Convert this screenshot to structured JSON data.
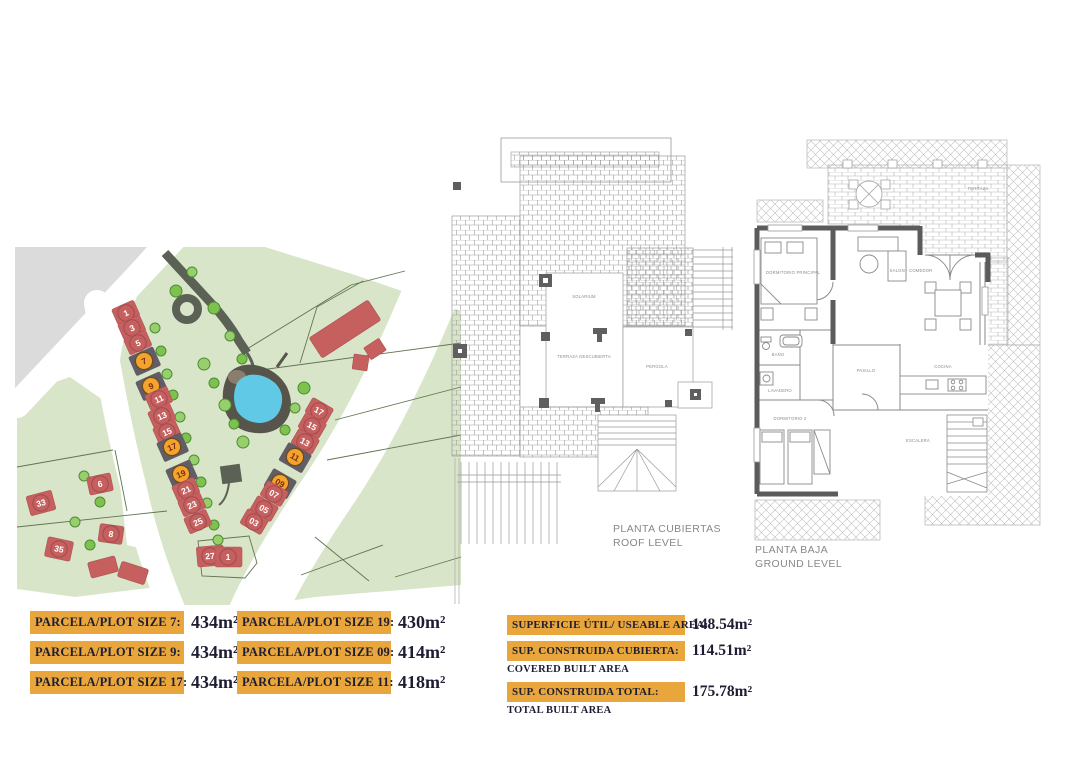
{
  "colors": {
    "table_bar": "#E8A63C",
    "table_text": "#1D1D33",
    "map_green": "#D8E5C9",
    "map_building": "#C6605F",
    "map_highlight": "#F3A42C",
    "map_pond": "#5FC9E6",
    "map_grey": "#DBDBDB",
    "plan_wall": "#5B5B5B"
  },
  "site_map": {
    "plots": [
      {
        "n": "1",
        "hl": false
      },
      {
        "n": "3",
        "hl": false
      },
      {
        "n": "5",
        "hl": false
      },
      {
        "n": "7",
        "hl": true
      },
      {
        "n": "9",
        "hl": true
      },
      {
        "n": "11",
        "hl": false
      },
      {
        "n": "13",
        "hl": false
      },
      {
        "n": "15",
        "hl": false
      },
      {
        "n": "17",
        "hl": true
      },
      {
        "n": "19",
        "hl": true
      },
      {
        "n": "21",
        "hl": false
      },
      {
        "n": "23",
        "hl": false
      },
      {
        "n": "25",
        "hl": false
      },
      {
        "n": "27",
        "hl": false
      },
      {
        "n": "1",
        "hl": false
      },
      {
        "n": "17",
        "hl": false
      },
      {
        "n": "15",
        "hl": false
      },
      {
        "n": "13",
        "hl": false
      },
      {
        "n": "11",
        "hl": true
      },
      {
        "n": "09",
        "hl": true
      },
      {
        "n": "07",
        "hl": false
      },
      {
        "n": "05",
        "hl": false
      },
      {
        "n": "03",
        "hl": false
      },
      {
        "n": "33",
        "hl": false
      },
      {
        "n": "35",
        "hl": false
      },
      {
        "n": "6",
        "hl": false
      },
      {
        "n": "8",
        "hl": false
      }
    ]
  },
  "plans": {
    "roof": {
      "title": "PLANTA CUBIERTAS",
      "subtitle": "ROOF LEVEL",
      "rooms": [
        {
          "name": "SOLARIUM"
        },
        {
          "name": "TERRAZA DESCUBIERTA"
        },
        {
          "name": "PERGOLA"
        }
      ]
    },
    "ground": {
      "title": "PLANTA BAJA",
      "subtitle": "GROUND LEVEL",
      "rooms": [
        {
          "name": "DORMITORIO PRINCIPAL"
        },
        {
          "name": "SALON - COMEDOR"
        },
        {
          "name": "COCINA"
        },
        {
          "name": "BAÑO"
        },
        {
          "name": "LAVADERO"
        },
        {
          "name": "DORMITORIO 2"
        },
        {
          "name": "PASILLO"
        },
        {
          "name": "TERRAZA"
        },
        {
          "name": "ESCALERA"
        }
      ]
    }
  },
  "tables": {
    "plot_sizes": [
      {
        "label": "PARCELA/PLOT SIZE 7:",
        "value": "434m²"
      },
      {
        "label": "PARCELA/PLOT SIZE 9:",
        "value": "434m²"
      },
      {
        "label": "PARCELA/PLOT SIZE 17:",
        "value": "434m²"
      },
      {
        "label": "PARCELA/PLOT SIZE 19:",
        "value": "430m²"
      },
      {
        "label": "PARCELA/PLOT SIZE 09:",
        "value": "414m²"
      },
      {
        "label": "PARCELA/PLOT SIZE 11:",
        "value": "418m²"
      }
    ],
    "summary": [
      {
        "label": "SUPERFICIE ÚTIL/ USEABLE AREA:",
        "sublabel": "",
        "value": "148.54m²"
      },
      {
        "label": "SUP. CONSTRUIDA CUBIERTA:",
        "sublabel": "COVERED BUILT AREA",
        "value": "114.51m²"
      },
      {
        "label": "SUP. CONSTRUIDA TOTAL:",
        "sublabel": "TOTAL BUILT AREA",
        "value": "175.78m²"
      }
    ]
  }
}
